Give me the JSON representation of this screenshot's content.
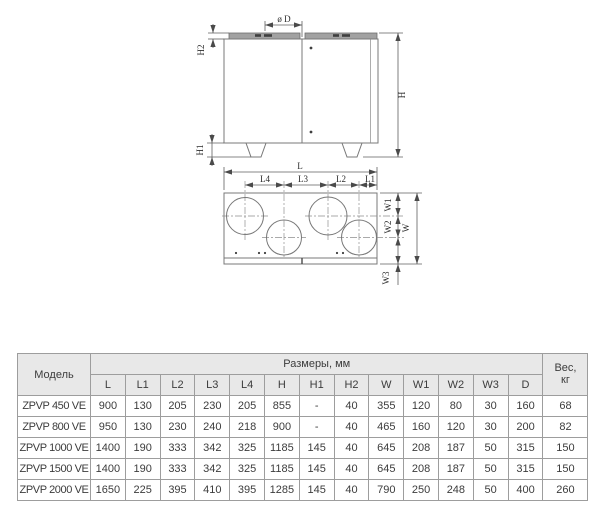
{
  "drawing": {
    "front_view_labels": {
      "diameter": "ø D",
      "h2": "H2",
      "h1": "H1",
      "h": "H"
    },
    "top_view_labels": {
      "l": "L",
      "l4": "L4",
      "l3": "L3",
      "l2": "L2",
      "l1": "L1",
      "w1": "W1",
      "w2": "W2",
      "w": "W",
      "w3": "W3"
    }
  },
  "table": {
    "model_header": "Модель",
    "dimensions_header": "Размеры, мм",
    "weight_header_line1": "Вес,",
    "weight_header_line2": "кг",
    "dimension_columns": [
      "L",
      "L1",
      "L2",
      "L3",
      "L4",
      "H",
      "H1",
      "H2",
      "W",
      "W1",
      "W2",
      "W3",
      "D"
    ],
    "rows": [
      {
        "model": "ZPVP 450 VE",
        "values": [
          "900",
          "130",
          "205",
          "230",
          "205",
          "855",
          "-",
          "40",
          "355",
          "120",
          "80",
          "30",
          "160"
        ],
        "weight": "68"
      },
      {
        "model": "ZPVP 800 VE",
        "values": [
          "950",
          "130",
          "230",
          "240",
          "218",
          "900",
          "-",
          "40",
          "465",
          "160",
          "120",
          "30",
          "200"
        ],
        "weight": "82"
      },
      {
        "model": "ZPVP 1000 VE",
        "values": [
          "1400",
          "190",
          "333",
          "342",
          "325",
          "1185",
          "145",
          "40",
          "645",
          "208",
          "187",
          "50",
          "315"
        ],
        "weight": "150"
      },
      {
        "model": "ZPVP 1500 VE",
        "values": [
          "1400",
          "190",
          "333",
          "342",
          "325",
          "1185",
          "145",
          "40",
          "645",
          "208",
          "187",
          "50",
          "315"
        ],
        "weight": "150"
      },
      {
        "model": "ZPVP 2000 VE",
        "values": [
          "1650",
          "225",
          "395",
          "410",
          "395",
          "1285",
          "145",
          "40",
          "790",
          "250",
          "248",
          "50",
          "400"
        ],
        "weight": "260"
      }
    ]
  },
  "colors": {
    "header_bg": "#e8e8e8",
    "table_border": "#9d9d9d",
    "line": "#787878",
    "roof_fill": "#a2a2a2"
  }
}
